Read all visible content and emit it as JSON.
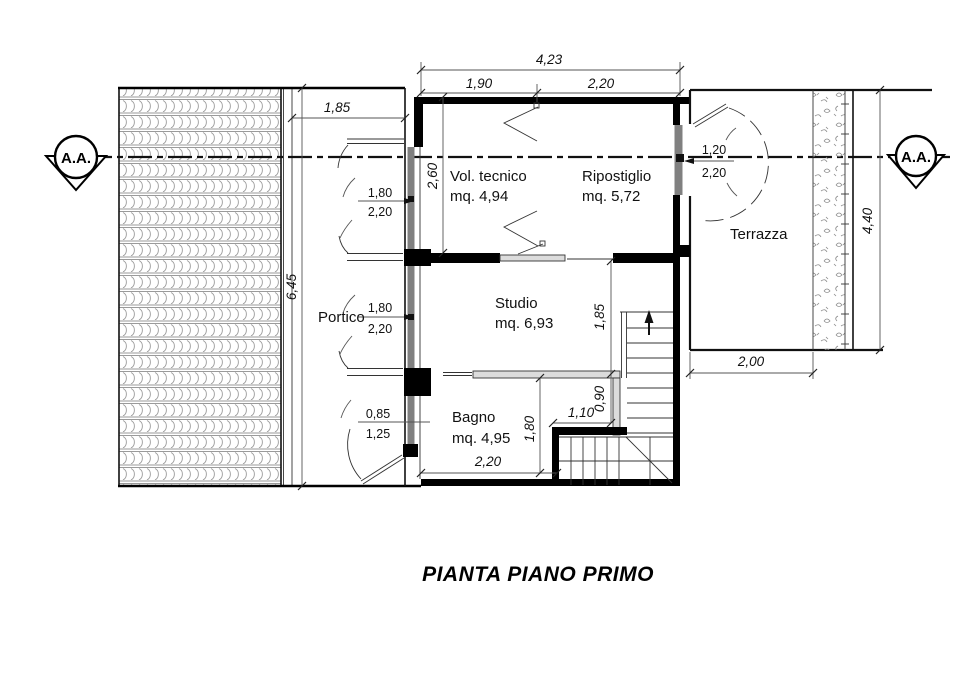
{
  "title": "PIANTA PIANO PRIMO",
  "section_markers": {
    "left": "A.A.",
    "right": "A.A."
  },
  "rooms": {
    "portico": "Portico",
    "vol_tecnico_name": "Vol. tecnico",
    "vol_tecnico_area": "mq. 4,94",
    "ripostiglio_name": "Ripostiglio",
    "ripostiglio_area": "mq. 5,72",
    "terrazza": "Terrazza",
    "studio_name": "Studio",
    "studio_area": "mq. 6,93",
    "bagno_name": "Bagno",
    "bagno_area": "mq. 4,95"
  },
  "dimensions": {
    "total_width": "4,23",
    "vol_tecnico_width": "1,90",
    "ripostiglio_width": "2,20",
    "portico_width": "1,85",
    "portico_length": "6,45",
    "vol_tecnico_depth": "2,60",
    "stair_length": "1,85",
    "stair_width": "0,90",
    "stair_landing": "1,10",
    "bagno_depth": "1,80",
    "bagno_width": "2,20",
    "terrazza_width": "2,00",
    "terrazza_length": "4,40"
  },
  "openings": {
    "portico_window_upper_w": "1,80",
    "portico_window_upper_h": "2,20",
    "portico_window_lower_w": "1,80",
    "portico_window_lower_h": "2,20",
    "bagno_window_w": "0,85",
    "bagno_window_h": "1,25",
    "terrazza_door_w": "1,20",
    "terrazza_door_h": "2,20"
  },
  "colors": {
    "wall": "#000000",
    "line": "#333333",
    "dimension": "#555555",
    "glazing": "#808080",
    "roof_hatch": "#9a9a9a",
    "background": "#ffffff"
  }
}
